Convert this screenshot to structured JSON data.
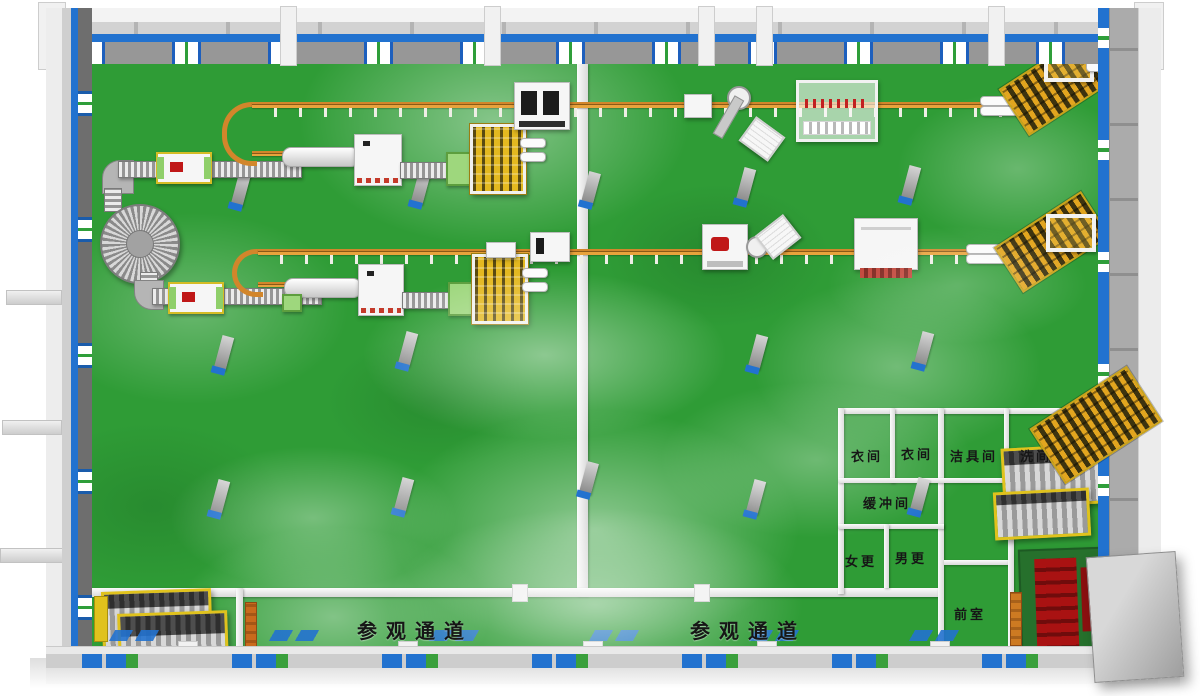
{
  "labels": {
    "corridor_left": "参观通道",
    "corridor_right": "参观通道",
    "rooms": {
      "cloak_1": "衣间",
      "cloak_2": "衣间",
      "tools": "洁具间",
      "wash": "洗间",
      "buffer": "缓冲间",
      "women": "女更",
      "men": "男更",
      "ante": "前室"
    }
  },
  "colors": {
    "floor_green": "#2f9c36",
    "accent_blue": "#2272cf",
    "conveyor_orange": "#d2862b",
    "safety_yellow": "#e3b820",
    "wall_gray": "#9b9b9b",
    "machine_white": "#f4f4f4",
    "alert_red": "#c01818",
    "dark_room_green": "#26702c"
  }
}
